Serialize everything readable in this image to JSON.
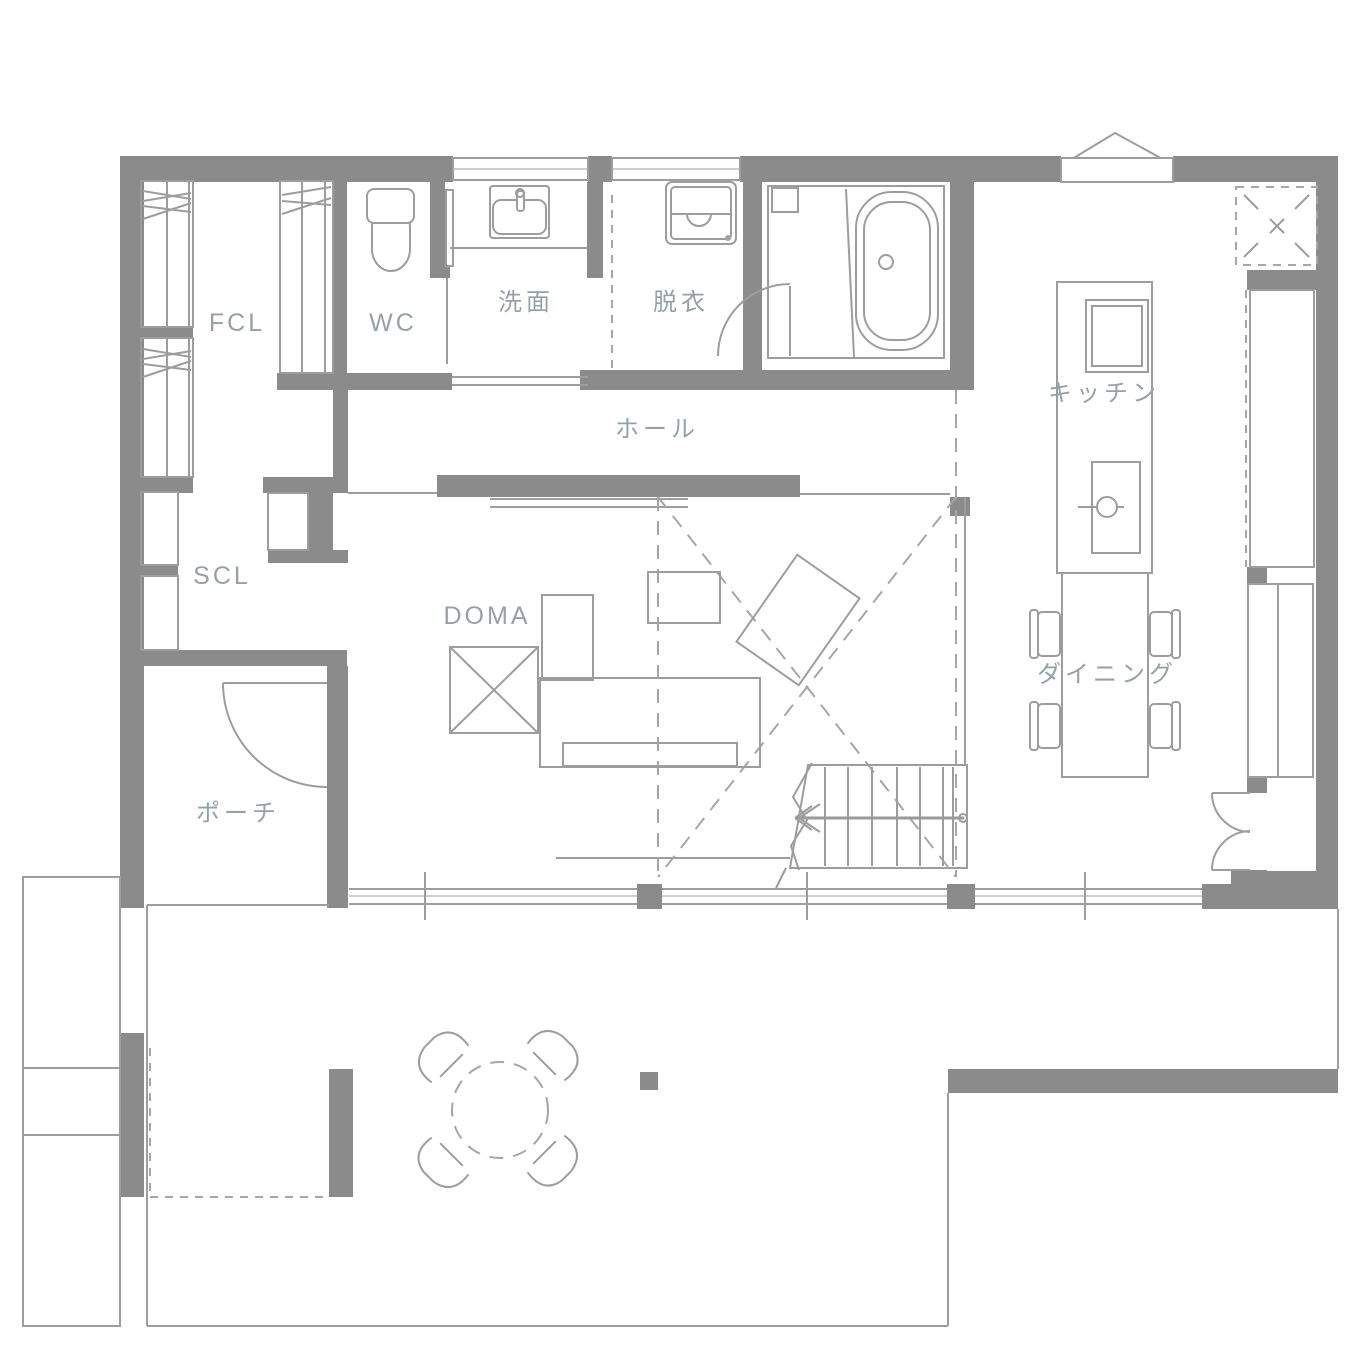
{
  "plan": {
    "title": "1F floor plan",
    "rooms": {
      "fcl": {
        "label": "FCL"
      },
      "wc": {
        "label": "WC"
      },
      "senmen": {
        "label": "洗面"
      },
      "datsui": {
        "label": "脱衣"
      },
      "hall": {
        "label": "ホール"
      },
      "kitchen": {
        "label": "キッチン"
      },
      "scl": {
        "label": "SCL"
      },
      "doma": {
        "label": "DOMA"
      },
      "dining": {
        "label": "ダイニング"
      },
      "porch": {
        "label": "ポーチ"
      }
    },
    "colors": {
      "wall": "#8b8b8b",
      "line": "#9d9d9d",
      "dashed_line": "#a6a6a6",
      "label_text": "#96a1a7",
      "background": "#ffffff"
    }
  }
}
